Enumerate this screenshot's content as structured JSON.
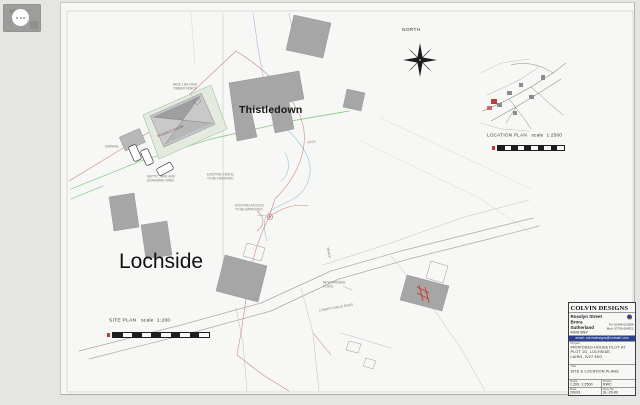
{
  "colors": {
    "boundary_red": "#c98181",
    "services_green": "#93cf93",
    "water_blue": "#9db9dd",
    "stream_cyan": "#a3cbe0",
    "marker_red": "#c23b3b",
    "email_bar": "#2b3f8f"
  },
  "plan": {
    "north": "NORTH",
    "thistledown": "Thistledown",
    "lochside": "Lochside",
    "possible_house": "POSSIBLE HOUSE",
    "garage": "GARAGE",
    "dim": "33.0m",
    "annotations": [
      {
        "text": "SEPTIC TANK AND\nSOAKAWAY AREA"
      },
      {
        "text": "EXISTING FENCE\nTO BE REMOVED"
      },
      {
        "text": "EXISTING ACCESS\nTO BE IMPROVED"
      },
      {
        "text": "NEW PASSING\nPLACE"
      },
      {
        "text": "TRACK"
      },
      {
        "text": "LOWER PUBLIC ROAD"
      },
      {
        "text": "NEW 1.8m HIGH\nTIMBER FENCE"
      }
    ],
    "site_caption": "SITE PLAN   scale  1:200",
    "location_caption": "LOCATION PLAN   scale  1:2500"
  },
  "title_block": {
    "firm": "COLVIN DESIGNS",
    "address": [
      "Rosslyn Street",
      "Brora",
      "Sutherland",
      "KW9 6NY"
    ],
    "tel": "Tel: 01408 621884",
    "mob": "Mob: 07790 654321",
    "email": "email: colvindesigns@hotmail.com",
    "project_label": "Project",
    "project": "PROPOSED HOUSE PLOT AT\nPLOT 1G, LOCHSIDE,\nLAIRG, IV27 4EG",
    "title_label": "Title",
    "title": "SITE & LOCATION PLANS",
    "scale_label": "Scale",
    "scale": "1:200, 1:2500",
    "drawn_label": "Drawn",
    "drawn": "RWC",
    "date_label": "Date",
    "date": "2/6/03",
    "dwg_label": "Dwg No",
    "dwg": "SL-29-00"
  }
}
